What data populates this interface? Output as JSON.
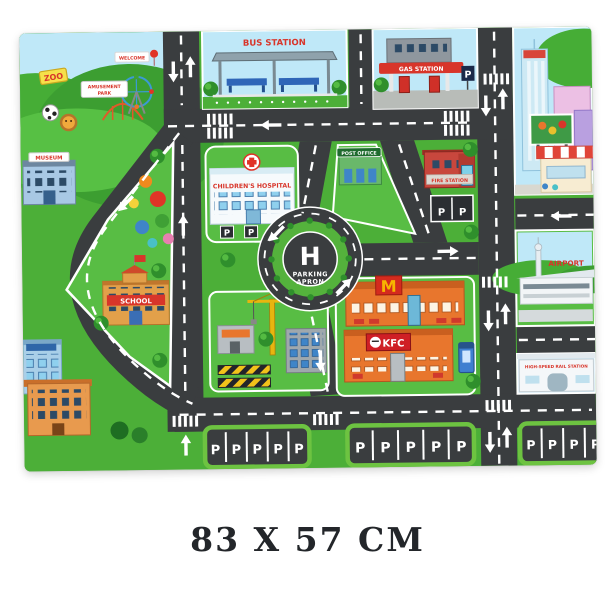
{
  "caption": {
    "size_label": "83 X 57 CM"
  },
  "mat": {
    "top_left": {
      "zoo": "ZOO",
      "welcome": "WELCOME",
      "amusement_line1": "AMUSEMENT",
      "amusement_line2": "PARK",
      "museum": "MUSEUM"
    },
    "stations": {
      "bus": "BUS STATION",
      "gas": "GAS STATION",
      "post_office": "POST OFFICE",
      "fire": "FIRE STATION",
      "airport": "AIRPORT",
      "rail": "HIGH-SPEED RAIL STATION"
    },
    "buildings": {
      "hospital": "CHILDREN'S HOSPITAL",
      "school": "SCHOOL",
      "kfc": "KFC",
      "mcdonalds_m": "M"
    },
    "heliport": {
      "h": "H",
      "line1": "PARKING",
      "line2": "APRON"
    },
    "parking_stall": "P",
    "parking_lots": {
      "lot1": [
        "P",
        "P",
        "P",
        "P",
        "P"
      ],
      "lot2": [
        "P",
        "P",
        "P",
        "P",
        "P"
      ],
      "lot3": [
        "P",
        "P",
        "P",
        "P"
      ]
    },
    "colors": {
      "road": "#3a3d3f",
      "grass": "#4caf38",
      "block_grass": "#58bd44",
      "sky": "#bfe8f8",
      "label_red": "#d8352a",
      "lot_border": "#6dc341"
    }
  }
}
